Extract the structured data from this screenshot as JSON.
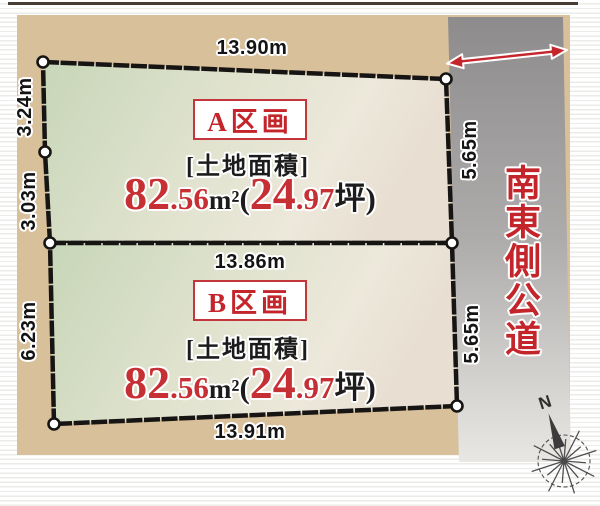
{
  "colors": {
    "accent_red": "#c3252b",
    "number_red": "#c62f33",
    "canvas_tan": "#d8c09b",
    "road_gray_top": "#8d8b8c",
    "road_gray_bottom": "#e9e7e4",
    "outline_black": "#171513"
  },
  "plots": [
    {
      "name": "A区画",
      "area_caption": "[土地面積]",
      "area_int": "82",
      "area_frac": ".56",
      "area_unit": "m²",
      "paren_open": "(",
      "tsubo_int": "24",
      "tsubo_frac": ".97",
      "tsubo_close": "坪)",
      "dims": {
        "top": "13.90m",
        "left_upper": "3.24m",
        "left_lower": "3.03m",
        "right": "5.65m"
      }
    },
    {
      "name": "B区画",
      "area_caption": "[土地面積]",
      "area_int": "82",
      "area_frac": ".56",
      "area_unit": "m²",
      "paren_open": "(",
      "tsubo_int": "24",
      "tsubo_frac": ".97",
      "tsubo_close": "坪)",
      "dims": {
        "top": "13.86m",
        "left": "6.23m",
        "right": "5.65m",
        "bottom": "13.91m"
      }
    }
  ],
  "road": {
    "label": "南東側公道"
  },
  "compass": {
    "north": "N"
  }
}
